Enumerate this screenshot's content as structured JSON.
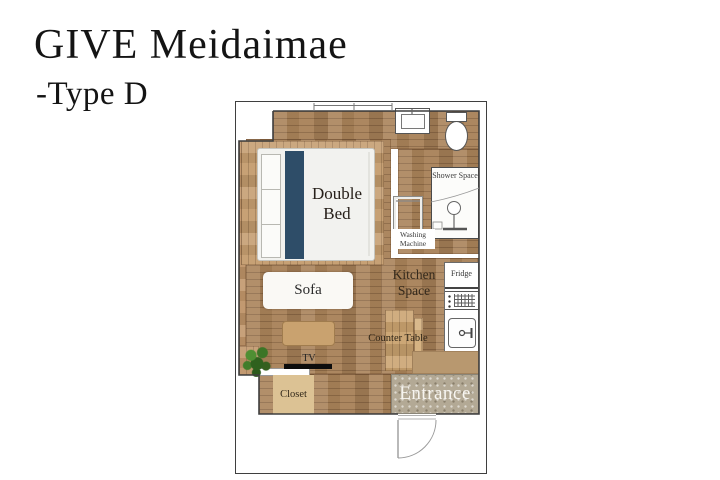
{
  "header": {
    "title": "GIVE Meidaimae",
    "subtitle": "-Type D"
  },
  "floorplan": {
    "labels": {
      "double_bed": "Double Bed",
      "sofa": "Sofa",
      "kitchen_space": "Kitchen Space",
      "counter_table": "Counter Table",
      "shower_space": "Shower Space",
      "washing_machine": "Washing Machine",
      "fridge": "Fridge",
      "tv": "TV",
      "closet": "Closet",
      "entrance": "Entrance"
    },
    "colors": {
      "wood_floor": "#a98259",
      "wood_wall": "#bf9468",
      "bed_platform": "#c49c6e",
      "bed_accent": "#2e4d68",
      "table_wood": "#c9a26f",
      "closet_wood": "#dcc294",
      "entrance_floor": "#b3a995",
      "plant_green": "#3e7c2b",
      "wall_line": "#3f3f3f"
    }
  }
}
